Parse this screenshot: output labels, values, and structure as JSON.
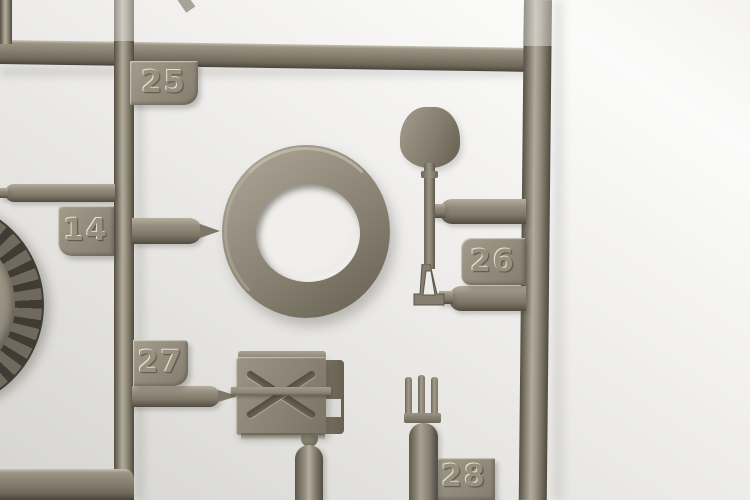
{
  "photo": {
    "subject": "olive-drab plastic model kit sprue (parts tree) on light backdrop",
    "colors": {
      "plastic_mid": "#8a8375",
      "plastic_highlight": "#b2ab9c",
      "plastic_shadow": "#514c42",
      "backdrop": "#efeeec"
    }
  },
  "part_tags": [
    {
      "label": "25"
    },
    {
      "label": "14"
    },
    {
      "label": "26"
    },
    {
      "label": "27"
    },
    {
      "label": "28"
    }
  ],
  "parts": [
    {
      "name": "road-wheel"
    },
    {
      "name": "tire-ring"
    },
    {
      "name": "shovel"
    },
    {
      "name": "jerry-can"
    },
    {
      "name": "pitchfork"
    }
  ]
}
